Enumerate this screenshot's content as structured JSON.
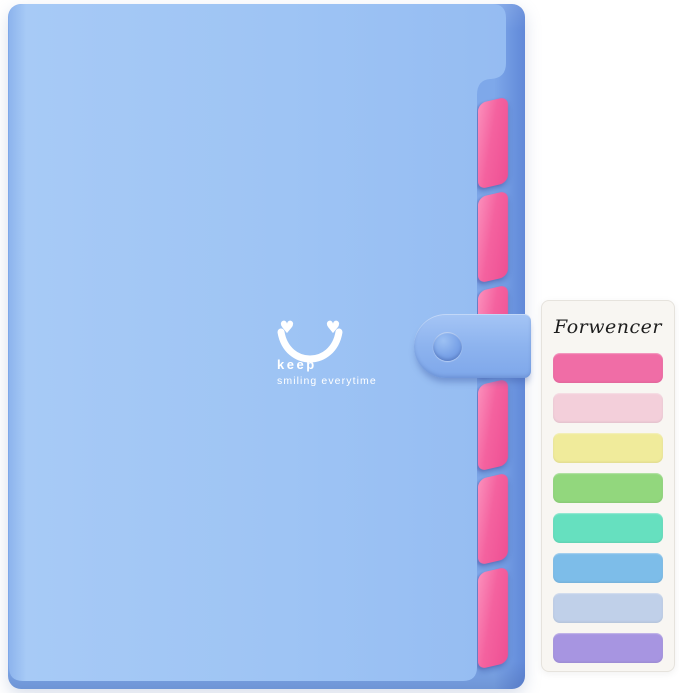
{
  "folder": {
    "graphic": {
      "heart_glyph": "♥",
      "left_eye_icon": "heart",
      "right_eye_icon": "heart",
      "mouth": "smile-arc",
      "line1": "keep",
      "line2": "smiling everytime",
      "graphic_color": "#ffffff"
    },
    "divider_tab_count": 6,
    "colors": {
      "cover": "#9ec4f4",
      "cover_light": "#a7caf6",
      "cover_dark": "#95bcf2",
      "spine": "#8db4ed",
      "edge": "#7ea8ea",
      "edge_dark": "#6088d8",
      "strap": "#8eb4ef",
      "strap_light": "#a5c5f5",
      "strap_dark": "#7ea7ea",
      "button": "#7aa3e8",
      "divider_pink": "#f4629f",
      "divider_pink_light": "#fb90bc",
      "divider_pink_dark": "#ee4f93"
    }
  },
  "card": {
    "brand": "Forwencer",
    "background": "#f8f6f2",
    "border": "#e6e3dd",
    "tab_colors": [
      "#f06da6",
      "#f3cfda",
      "#f0eb9b",
      "#92d77d",
      "#66e0bf",
      "#7dbde9",
      "#c0d0e9",
      "#a795e1"
    ]
  }
}
